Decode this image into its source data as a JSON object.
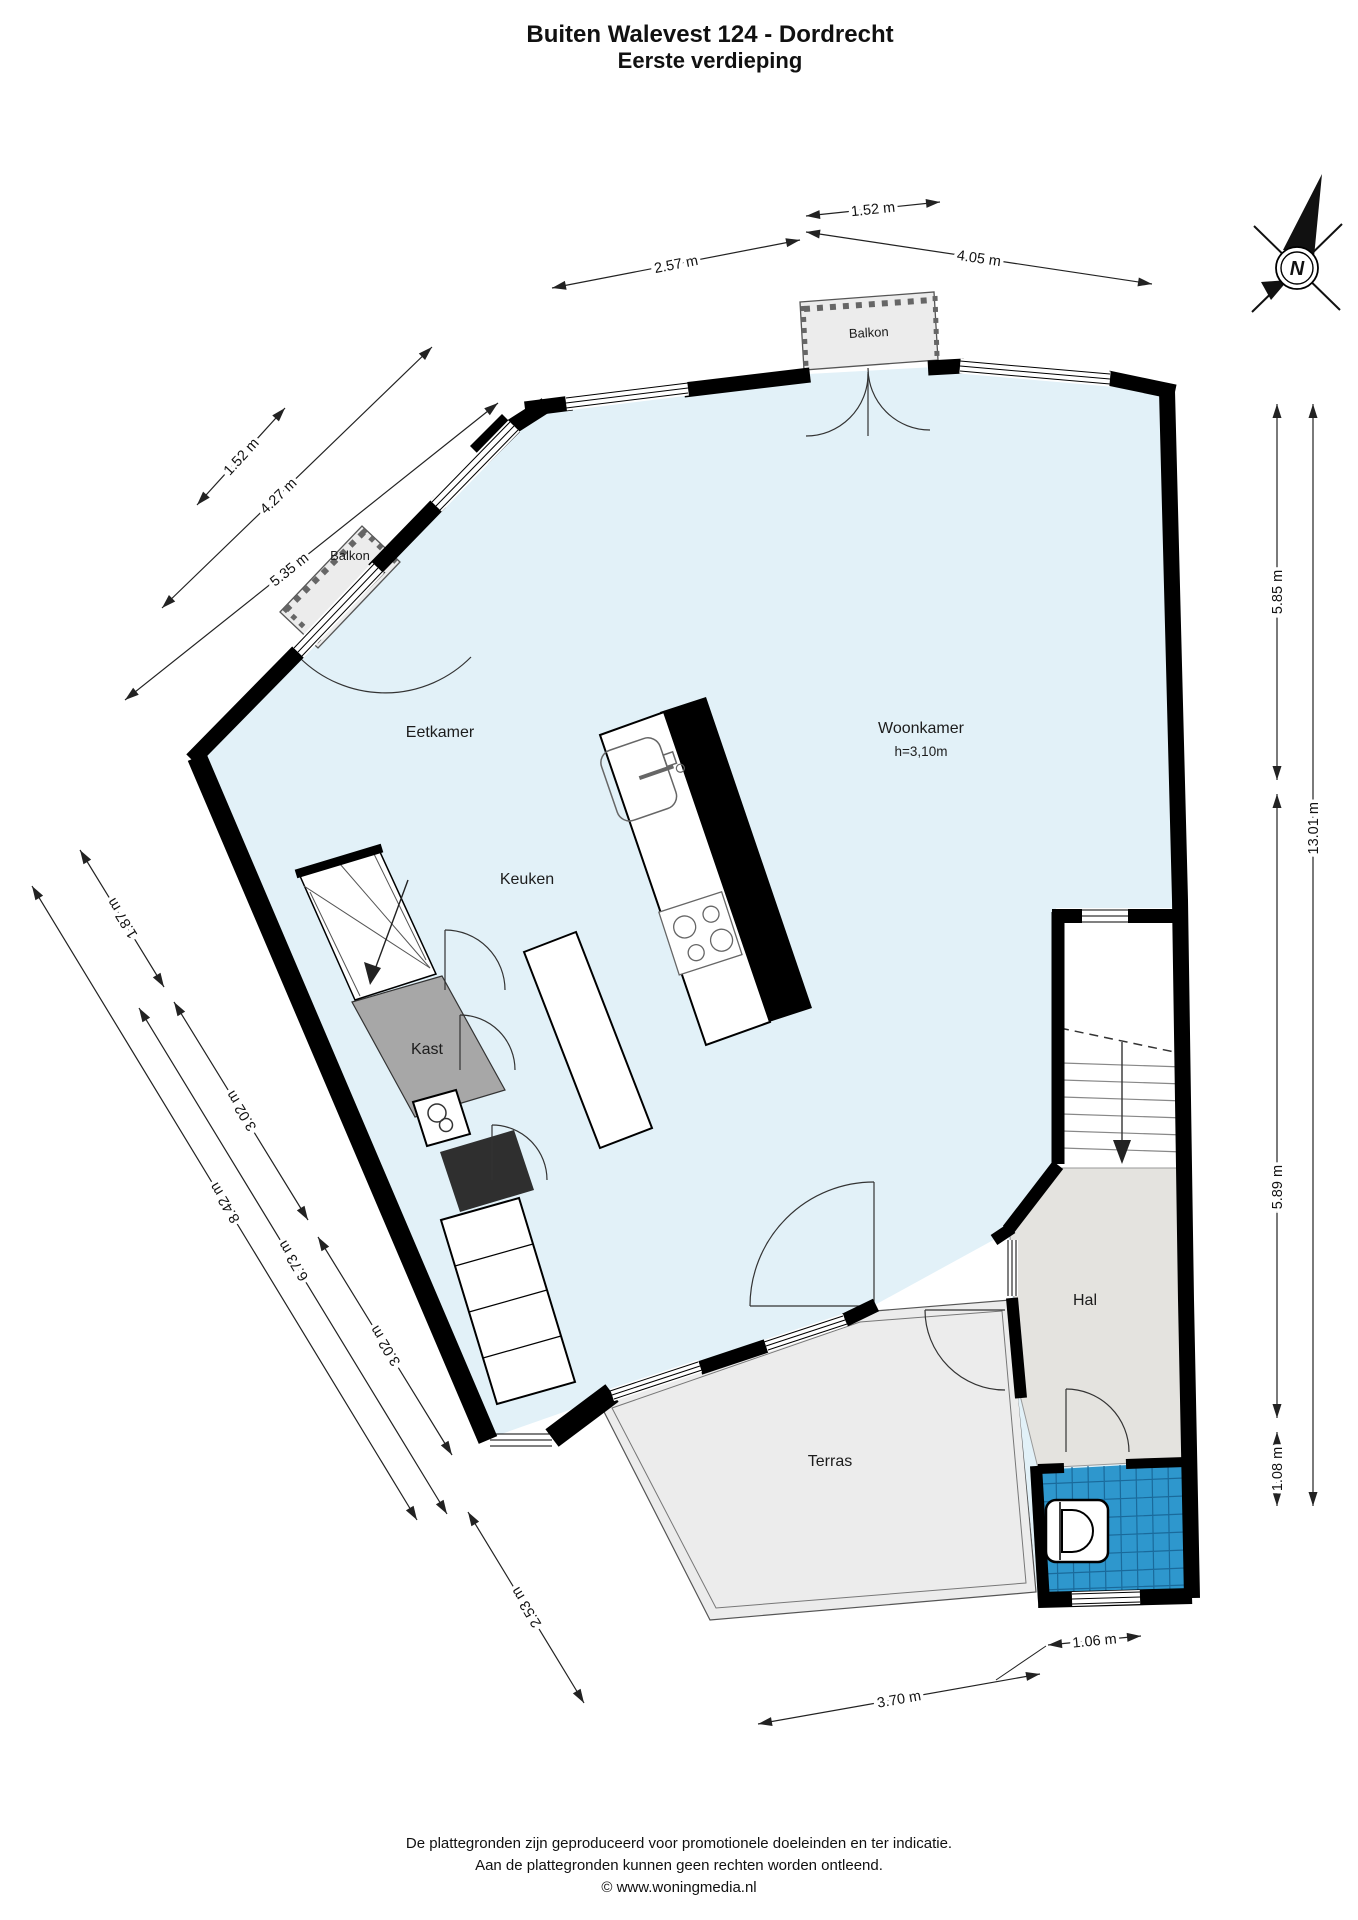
{
  "title": {
    "line1": "Buiten Walevest 124 - Dordrecht",
    "line2": "Eerste verdieping"
  },
  "compass": {
    "north_label": "N"
  },
  "rooms": {
    "eetkamer": "Eetkamer",
    "keuken": "Keuken",
    "woonkamer": "Woonkamer",
    "woonkamer_height": "h=3,10m",
    "kast": "Kast",
    "hal": "Hal",
    "terras": "Terras",
    "balkon_top": "Balkon",
    "balkon_left": "Balkon"
  },
  "dimensions": {
    "top": [
      "1.52 m",
      "2.57 m",
      "4.05 m"
    ],
    "left_upper": [
      "1.52 m",
      "4.27 m",
      "5.35 m"
    ],
    "left_lower": [
      "1.87 m",
      "3.02 m",
      "6.73 m",
      "8.42 m",
      "3.02 m",
      "2.53 m"
    ],
    "right": [
      "5.85 m",
      "5.89 m",
      "1.08 m",
      "13.01 m"
    ],
    "bottom": [
      "1.06 m",
      "3.70 m"
    ]
  },
  "footer": {
    "line1": "De plattegronden zijn geproduceerd voor promotionele doeleinden en ter indicatie.",
    "line2": "Aan de plattegronden kunnen geen rechten worden ontleend.",
    "line3": "© www.woningmedia.nl"
  },
  "colors": {
    "floor": "#e2f1f8",
    "hal_floor": "#e4e3df",
    "terras_floor": "#ececec",
    "kast_floor": "#a7a7a7",
    "toilet_tiles": "#2e97cd",
    "wall": "#000000"
  }
}
